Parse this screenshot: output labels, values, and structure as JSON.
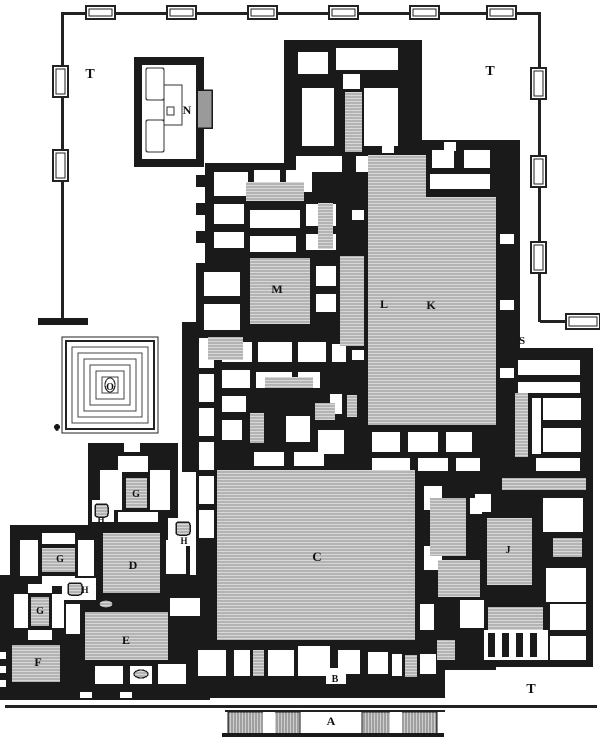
{
  "colors": {
    "ink": "#1a1a1a",
    "paper": "#ffffff",
    "hatch_bg": "#d7d7d7",
    "hatch_line": "#8f8f8f",
    "gray_block": "#9a9a9a",
    "line": "#222222"
  },
  "labels": [
    {
      "t": "T",
      "x": 90,
      "y": 78,
      "s": 14
    },
    {
      "t": "T",
      "x": 490,
      "y": 75,
      "s": 14
    },
    {
      "t": "T",
      "x": 531,
      "y": 693,
      "s": 14
    },
    {
      "t": "N",
      "x": 187,
      "y": 114,
      "s": 12
    },
    {
      "t": "M",
      "x": 277,
      "y": 293,
      "s": 12
    },
    {
      "t": "L",
      "x": 384,
      "y": 308,
      "s": 12
    },
    {
      "t": "K",
      "x": 431,
      "y": 309,
      "s": 12
    },
    {
      "t": "S",
      "x": 522,
      "y": 344,
      "s": 11
    },
    {
      "t": "O",
      "x": 110,
      "y": 390,
      "s": 10
    },
    {
      "t": "c",
      "x": 57,
      "y": 431,
      "s": 9
    },
    {
      "t": "G",
      "x": 136,
      "y": 497,
      "s": 10
    },
    {
      "t": "G",
      "x": 60,
      "y": 562,
      "s": 10
    },
    {
      "t": "G",
      "x": 40,
      "y": 614,
      "s": 10
    },
    {
      "t": "H",
      "x": 101,
      "y": 523,
      "s": 9
    },
    {
      "t": "H",
      "x": 184,
      "y": 544,
      "s": 9
    },
    {
      "t": "H",
      "x": 85,
      "y": 593,
      "s": 9
    },
    {
      "t": "D",
      "x": 133,
      "y": 569,
      "s": 12
    },
    {
      "t": "C",
      "x": 317,
      "y": 561,
      "s": 13
    },
    {
      "t": "J",
      "x": 508,
      "y": 553,
      "s": 10
    },
    {
      "t": "E",
      "x": 126,
      "y": 644,
      "s": 12
    },
    {
      "t": "F",
      "x": 38,
      "y": 666,
      "s": 12
    },
    {
      "t": "B",
      "x": 335,
      "y": 682,
      "s": 10
    },
    {
      "t": "A",
      "x": 331,
      "y": 725,
      "s": 12
    }
  ],
  "enclosure": {
    "lines": [
      [
        62,
        12,
        478,
        3
      ],
      [
        61,
        12,
        3,
        310
      ],
      [
        538,
        12,
        3,
        310
      ],
      [
        540,
        320,
        60,
        3
      ]
    ],
    "top_towers_x": [
      86,
      167,
      248,
      329,
      410,
      487
    ],
    "top_tower": {
      "y": 6,
      "w": 29,
      "h": 13
    },
    "left_towers_y": [
      66,
      150
    ],
    "left_tower": {
      "x": 53,
      "w": 15,
      "h": 31
    },
    "right_towers_y": [
      68,
      156,
      242
    ],
    "right_tower": {
      "x": 531,
      "w": 15,
      "h": 31
    },
    "se_tower": [
      566,
      314,
      34,
      15
    ],
    "west_stub": [
      38,
      318,
      50,
      7
    ]
  },
  "walls": [
    [
      284,
      40,
      138,
      139
    ],
    [
      205,
      163,
      143,
      100
    ],
    [
      196,
      263,
      168,
      75
    ],
    [
      348,
      140,
      172,
      290
    ],
    [
      182,
      322,
      18,
      150
    ],
    [
      196,
      330,
      168,
      140
    ],
    [
      364,
      423,
      156,
      57
    ],
    [
      480,
      348,
      113,
      292
    ],
    [
      196,
      440,
      300,
      230
    ],
    [
      88,
      443,
      90,
      85
    ],
    [
      10,
      525,
      180,
      75
    ],
    [
      0,
      575,
      210,
      125
    ],
    [
      165,
      640,
      280,
      58
    ],
    [
      413,
      595,
      180,
      72
    ],
    [
      497,
      330,
      23,
      30
    ],
    [
      196,
      175,
      9,
      12
    ],
    [
      196,
      203,
      9,
      12
    ],
    [
      196,
      231,
      9,
      12
    ],
    [
      340,
      71,
      23,
      21
    ]
  ],
  "rooms_white": [
    [
      298,
      52,
      30,
      22
    ],
    [
      336,
      48,
      62,
      22
    ],
    [
      302,
      88,
      32,
      58
    ],
    [
      364,
      88,
      34,
      58
    ],
    [
      296,
      156,
      46,
      16
    ],
    [
      356,
      156,
      48,
      16
    ],
    [
      214,
      172,
      34,
      24
    ],
    [
      254,
      170,
      26,
      22
    ],
    [
      286,
      170,
      26,
      22
    ],
    [
      214,
      204,
      30,
      20
    ],
    [
      214,
      232,
      30,
      16
    ],
    [
      250,
      210,
      50,
      18
    ],
    [
      306,
      204,
      30,
      22
    ],
    [
      306,
      234,
      30,
      16
    ],
    [
      250,
      236,
      46,
      16
    ],
    [
      204,
      272,
      36,
      24
    ],
    [
      204,
      304,
      36,
      26
    ],
    [
      316,
      266,
      20,
      20
    ],
    [
      316,
      294,
      20,
      18
    ],
    [
      432,
      150,
      22,
      18
    ],
    [
      464,
      150,
      26,
      18
    ],
    [
      430,
      174,
      60,
      15
    ],
    [
      500,
      234,
      14,
      10
    ],
    [
      500,
      300,
      14,
      10
    ],
    [
      500,
      368,
      14,
      10
    ],
    [
      382,
      144,
      12,
      9
    ],
    [
      444,
      142,
      12,
      9
    ],
    [
      352,
      210,
      12,
      10
    ],
    [
      352,
      280,
      12,
      10
    ],
    [
      352,
      350,
      12,
      10
    ],
    [
      199,
      338,
      15,
      200
    ],
    [
      222,
      342,
      30,
      20
    ],
    [
      258,
      342,
      34,
      20
    ],
    [
      298,
      342,
      28,
      20
    ],
    [
      332,
      344,
      14,
      18
    ],
    [
      222,
      370,
      28,
      18
    ],
    [
      256,
      372,
      36,
      16
    ],
    [
      298,
      372,
      22,
      16
    ],
    [
      222,
      396,
      24,
      16
    ],
    [
      222,
      420,
      20,
      20
    ],
    [
      254,
      452,
      30,
      14
    ],
    [
      286,
      416,
      24,
      26
    ],
    [
      318,
      430,
      26,
      24
    ],
    [
      294,
      452,
      30,
      14
    ],
    [
      330,
      394,
      12,
      20
    ],
    [
      372,
      432,
      28,
      20
    ],
    [
      408,
      432,
      30,
      20
    ],
    [
      446,
      432,
      26,
      20
    ],
    [
      372,
      458,
      38,
      13
    ],
    [
      418,
      458,
      30,
      13
    ],
    [
      456,
      458,
      24,
      13
    ],
    [
      518,
      360,
      62,
      15
    ],
    [
      518,
      382,
      62,
      11
    ],
    [
      543,
      398,
      38,
      22
    ],
    [
      543,
      428,
      38,
      24
    ],
    [
      536,
      458,
      44,
      13
    ],
    [
      532,
      398,
      9,
      56
    ],
    [
      543,
      498,
      40,
      34
    ],
    [
      475,
      494,
      16,
      18
    ],
    [
      546,
      568,
      40,
      34
    ],
    [
      550,
      604,
      36,
      26
    ],
    [
      550,
      636,
      36,
      24
    ],
    [
      460,
      600,
      24,
      28
    ],
    [
      484,
      630,
      64,
      30
    ],
    [
      420,
      604,
      14,
      26
    ],
    [
      424,
      486,
      18,
      24
    ],
    [
      424,
      546,
      18,
      24
    ],
    [
      470,
      498,
      12,
      16
    ],
    [
      100,
      470,
      22,
      40
    ],
    [
      118,
      456,
      30,
      16
    ],
    [
      150,
      470,
      20,
      40
    ],
    [
      118,
      512,
      40,
      10
    ],
    [
      124,
      443,
      16,
      9
    ],
    [
      92,
      500,
      22,
      22
    ],
    [
      20,
      540,
      18,
      36
    ],
    [
      78,
      540,
      16,
      36
    ],
    [
      42,
      533,
      33,
      11
    ],
    [
      42,
      576,
      33,
      10
    ],
    [
      166,
      540,
      20,
      34
    ],
    [
      168,
      518,
      24,
      28
    ],
    [
      14,
      594,
      14,
      34
    ],
    [
      52,
      594,
      12,
      34
    ],
    [
      28,
      584,
      24,
      9
    ],
    [
      28,
      630,
      24,
      10
    ],
    [
      62,
      578,
      34,
      22
    ],
    [
      66,
      604,
      14,
      30
    ],
    [
      95,
      666,
      28,
      18
    ],
    [
      130,
      666,
      22,
      18
    ],
    [
      158,
      664,
      28,
      20
    ],
    [
      170,
      598,
      30,
      18
    ],
    [
      198,
      650,
      28,
      26
    ],
    [
      234,
      650,
      16,
      26
    ],
    [
      268,
      650,
      26,
      26
    ],
    [
      298,
      646,
      32,
      30
    ],
    [
      338,
      650,
      22,
      24
    ],
    [
      368,
      652,
      20,
      22
    ],
    [
      392,
      654,
      10,
      22
    ],
    [
      420,
      654,
      16,
      20
    ],
    [
      326,
      668,
      20,
      16
    ],
    [
      80,
      692,
      12,
      6
    ],
    [
      120,
      692,
      12,
      6
    ],
    [
      0,
      652,
      6,
      7
    ],
    [
      0,
      666,
      6,
      7
    ],
    [
      0,
      680,
      6,
      7
    ],
    [
      376,
      296,
      18,
      16
    ],
    [
      343,
      74,
      17,
      15
    ]
  ],
  "piers": [
    [
      199,
      368,
      15,
      6
    ],
    [
      199,
      402,
      15,
      6
    ],
    [
      199,
      436,
      15,
      6
    ],
    [
      199,
      470,
      15,
      6
    ],
    [
      199,
      504,
      15,
      6
    ],
    [
      488,
      633,
      7,
      24
    ],
    [
      502,
      633,
      7,
      24
    ],
    [
      516,
      633,
      7,
      24
    ],
    [
      530,
      633,
      7,
      24
    ]
  ],
  "rooms_hatched": [
    [
      345,
      92,
      17,
      60
    ],
    [
      246,
      182,
      58,
      19
    ],
    [
      318,
      203,
      15,
      46
    ],
    [
      250,
      258,
      60,
      66
    ],
    [
      340,
      256,
      24,
      90
    ],
    [
      368,
      155,
      58,
      270
    ],
    [
      426,
      197,
      70,
      228
    ],
    [
      208,
      337,
      35,
      23
    ],
    [
      265,
      377,
      48,
      11
    ],
    [
      250,
      413,
      14,
      30
    ],
    [
      315,
      403,
      20,
      17
    ],
    [
      347,
      395,
      10,
      22
    ],
    [
      217,
      470,
      198,
      170
    ],
    [
      515,
      393,
      13,
      64
    ],
    [
      502,
      478,
      84,
      12
    ],
    [
      430,
      498,
      36,
      58
    ],
    [
      487,
      518,
      45,
      67
    ],
    [
      553,
      538,
      29,
      19
    ],
    [
      438,
      560,
      42,
      37
    ],
    [
      488,
      607,
      55,
      23
    ],
    [
      437,
      640,
      18,
      20
    ],
    [
      103,
      533,
      57,
      60
    ],
    [
      126,
      478,
      21,
      30
    ],
    [
      42,
      548,
      33,
      24
    ],
    [
      31,
      597,
      18,
      29
    ],
    [
      85,
      612,
      83,
      48
    ],
    [
      12,
      645,
      48,
      37
    ],
    [
      253,
      650,
      11,
      26
    ],
    [
      405,
      655,
      12,
      22
    ]
  ],
  "ramps": {
    "blocks": [
      [
        228,
        712,
        72,
        22
      ],
      [
        362,
        712,
        75,
        22
      ]
    ],
    "gaps": [
      [
        263,
        712,
        12,
        22
      ],
      [
        390,
        712,
        12,
        22
      ]
    ],
    "top_line": [
      225,
      710,
      220,
      2
    ],
    "bottom_line": [
      222,
      733,
      222,
      4
    ],
    "terrace_line": [
      5,
      705,
      592,
      3
    ]
  },
  "n_building": {
    "frame": [
      134,
      57,
      70,
      110
    ],
    "interior": [
      142,
      65,
      54,
      94
    ],
    "cells": [
      [
        146,
        68,
        18,
        32
      ],
      [
        146,
        120,
        18,
        32
      ]
    ],
    "thin_rects": [
      [
        164,
        85,
        18,
        40
      ],
      [
        167,
        107,
        7,
        8
      ]
    ],
    "annex": [
      197,
      90,
      15,
      38
    ]
  },
  "spiral": {
    "outer1": [
      62,
      337,
      96,
      96
    ],
    "outer2": [
      66,
      341,
      88,
      88
    ],
    "rings": [
      [
        72,
        347,
        76,
        76
      ],
      [
        78,
        353,
        64,
        64
      ],
      [
        84,
        359,
        52,
        52
      ],
      [
        90,
        365,
        40,
        40
      ],
      [
        96,
        371,
        28,
        28
      ],
      [
        102,
        377,
        16,
        16
      ]
    ],
    "center_oval": [
      110,
      385,
      5,
      7
    ],
    "dot": [
      57,
      427,
      3
    ]
  },
  "altars": [
    {
      "r": [
        95,
        504,
        13,
        13
      ]
    },
    {
      "r": [
        176,
        522,
        14,
        13
      ]
    },
    {
      "r": [
        68,
        583,
        14,
        12
      ]
    }
  ],
  "ovals": [
    [
      106,
      604,
      7,
      4
    ],
    [
      141,
      674,
      7,
      4
    ]
  ]
}
